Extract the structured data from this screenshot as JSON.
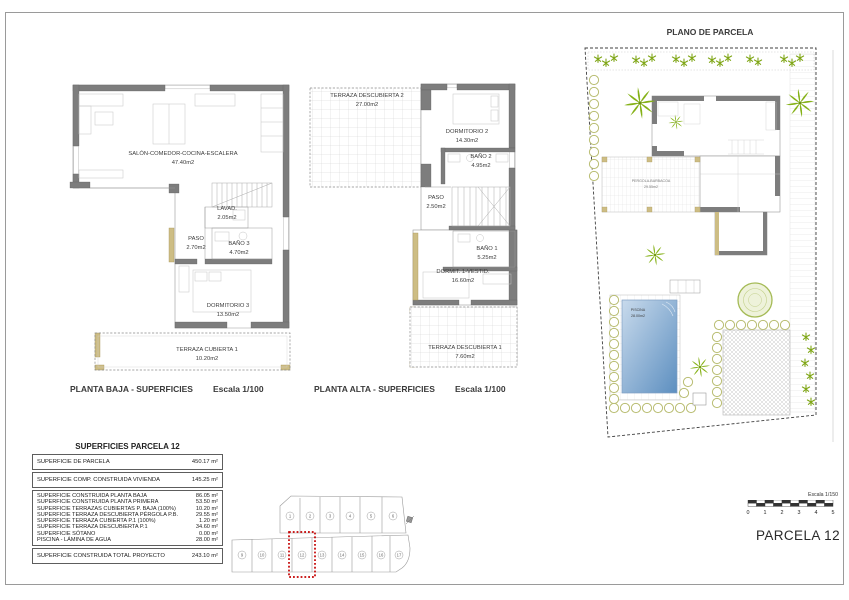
{
  "sheet": {
    "planta_baja": {
      "caption": "PLANTA BAJA - SUPERFICIES",
      "scale": "Escala 1/100",
      "rooms": {
        "salon": {
          "name": "SALÓN-COMEDOR-COCINA-ESCALERA",
          "area": "47.40m2"
        },
        "lavadero": {
          "name": "LAVAD.",
          "area": "2.05m2"
        },
        "paso": {
          "name": "PASO",
          "area": "2.70m2"
        },
        "bano3": {
          "name": "BAÑO 3",
          "area": "4.70m2"
        },
        "dormitorio3": {
          "name": "DORMITORIO 3",
          "area": "13.50m2"
        },
        "terraza_cubierta1": {
          "name": "TERRAZA CUBIERTA 1",
          "area": "10.20m2"
        }
      }
    },
    "planta_alta": {
      "caption": "PLANTA ALTA - SUPERFICIES",
      "scale": "Escala 1/100",
      "rooms": {
        "terraza_descubierta2": {
          "name": "TERRAZA DESCUBIERTA 2",
          "area": "27.00m2"
        },
        "dormitorio2": {
          "name": "DORMITORIO 2",
          "area": "14.30m2"
        },
        "bano2": {
          "name": "BAÑO 2",
          "area": "4.95m2"
        },
        "paso": {
          "name": "PASO",
          "area": "2.50m2"
        },
        "bano1": {
          "name": "BAÑO 1",
          "area": "5.25m2"
        },
        "dormitorio1": {
          "name": "DORMIT. 1-VESTID.",
          "area": "16.60m2"
        },
        "terraza_descubierta1": {
          "name": "TERRAZA DESCUBIERTA 1",
          "area": "7.60m2"
        }
      }
    },
    "plano_parcela": {
      "title": "PLANO DE PARCELA",
      "pergola": {
        "name": "PERGOLA-BARBACOA",
        "area": "29.55m2"
      },
      "piscina": {
        "name": "PISCINA",
        "area": "28.00m2"
      }
    },
    "tabla": {
      "title": "SUPERFICIES PARCELA 12",
      "seccion1": [
        {
          "label": "SUPERFICIE DE PARCELA",
          "value": "450.17 m²"
        }
      ],
      "seccion2": [
        {
          "label": "SUPERFICIE COMP. CONSTRUIDA VIVIENDA",
          "value": "145.25 m²"
        }
      ],
      "seccion3": [
        {
          "label": "SUPERFICIE CONSTRUIDA PLANTA BAJA",
          "value": "86.05 m²"
        },
        {
          "label": "SUPERFICIE CONSTRUIDA PLANTA PRIMERA",
          "value": "53.50 m²"
        },
        {
          "label": "SUPERFICIE TERRAZAS CUBIERTAS P. BAJA (100%)",
          "value": "10.20 m²"
        },
        {
          "label": "SUPERFICIE TERRAZA DESCUBIERTA PÉRGOLA P.B.",
          "value": "29.55 m²"
        },
        {
          "label": "SUPERFICIE TERRAZA CUBIERTA P.1 (100%)",
          "value": "1.20 m²"
        },
        {
          "label": "SUPERFICIE TERRAZA DESCUBIERTA P.1",
          "value": "34.60 m²"
        },
        {
          "label": "SUPERFICIE SÓTANO",
          "value": "0.00 m²"
        },
        {
          "label": "PISCINA - LÁMINA DE AGUA",
          "value": "28.00 m²"
        }
      ],
      "total": {
        "label": "SUPERFICIE CONSTRUIDA TOTAL PROYECTO",
        "value": "243.10 m²"
      }
    },
    "localizador": {
      "fila_superior": [
        "1",
        "2",
        "3",
        "4",
        "5",
        "6"
      ],
      "fila_inferior": [
        "9",
        "10",
        "11",
        "12",
        "13",
        "14",
        "15",
        "16",
        "17"
      ],
      "parcela_destacada": "12"
    },
    "escala_grafica": {
      "label": "Escala 1/150",
      "ticks": [
        "0",
        "1",
        "2",
        "3",
        "4",
        "5"
      ]
    },
    "parcela_label": "PARCELA 12",
    "colors": {
      "wall": "#7d7d7d",
      "tan_wall": "#cdbd84",
      "plant_green": "#85b117",
      "bush_olive": "#b9bd72",
      "pool_light": "#c8daec",
      "pool_dark": "#5d8fc0",
      "highlight_red": "#c40000"
    }
  }
}
